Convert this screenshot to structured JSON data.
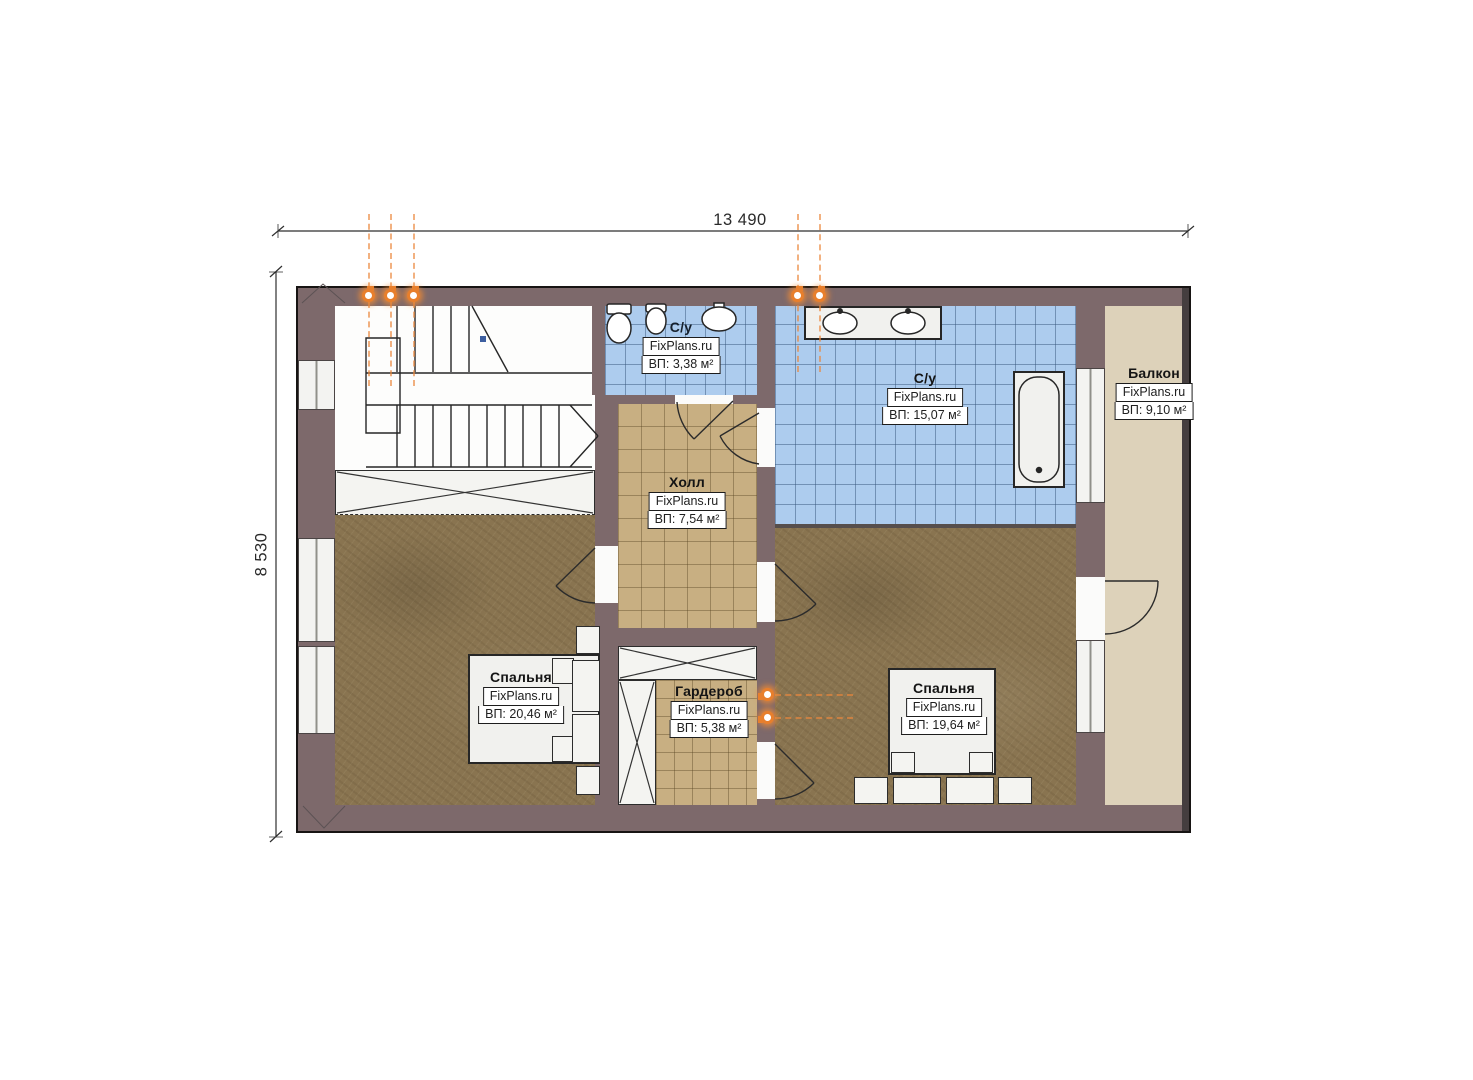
{
  "dimensions": {
    "width": "13 490",
    "height": "8 530"
  },
  "watermark": "FixPlans.ru",
  "rooms": {
    "bath_small": {
      "name": "С/у",
      "area": "ВП: 3,38 м²"
    },
    "bath_large": {
      "name": "С/у",
      "area": "ВП: 15,07 м²"
    },
    "hall": {
      "name": "Холл",
      "area": "ВП: 7,54 м²"
    },
    "balcony": {
      "name": "Балкон",
      "area": "ВП: 9,10 м²"
    },
    "bedroom_left": {
      "name": "Спальня",
      "area": "ВП: 20,46 м²"
    },
    "wardrobe": {
      "name": "Гардероб",
      "area": "ВП: 5,38 м²"
    },
    "bedroom_right": {
      "name": "Спальня",
      "area": "ВП: 19,64 м²"
    }
  },
  "colors": {
    "wall": "#7d696b",
    "floor_wood": "#897450",
    "tile_blue": "#adccee",
    "tile_tan": "#c8af82",
    "balcony_floor": "#ddd2ba",
    "accent_orange": "#e87f2c"
  }
}
